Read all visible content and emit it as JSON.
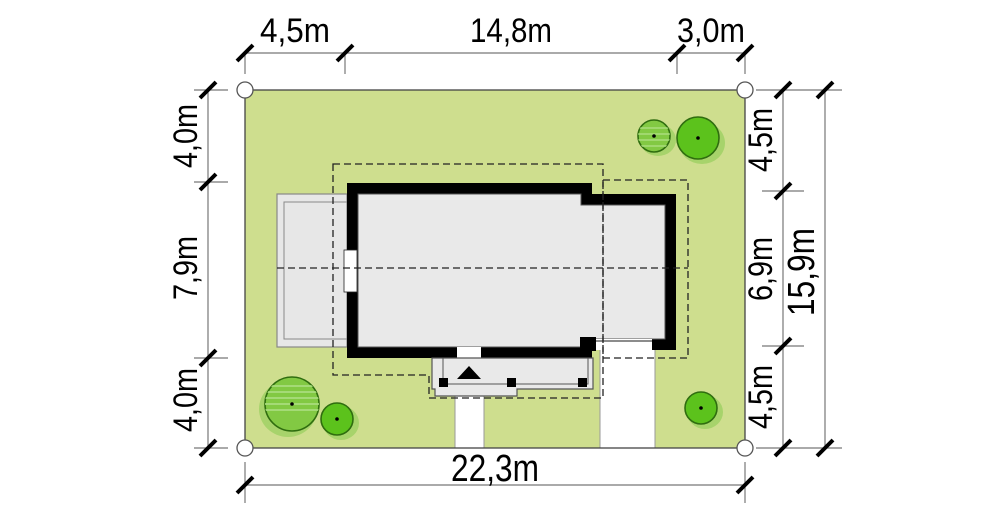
{
  "plan": {
    "type": "house-site-plan",
    "dimensions": {
      "top": [
        "4,5m",
        "14,8m",
        "3,0m"
      ],
      "left": [
        "4,0m",
        "7,9m",
        "4,0m"
      ],
      "right": [
        "4,5m",
        "6,9m",
        "4,5m"
      ],
      "right_total": "15,9m",
      "bottom_total": "22,3m"
    },
    "colors": {
      "plot_green": "#cede8e",
      "tree_bright_green": "#5cc21c",
      "tree_light_green": "#82c943",
      "tree_outline": "#2f6d0f",
      "wall_black": "#000000",
      "interior_gray": "#e9e9e9",
      "terrace_gray": "#e7e7e7",
      "paving_white": "#ffffff",
      "dimension_line_gray": "#777777"
    }
  }
}
